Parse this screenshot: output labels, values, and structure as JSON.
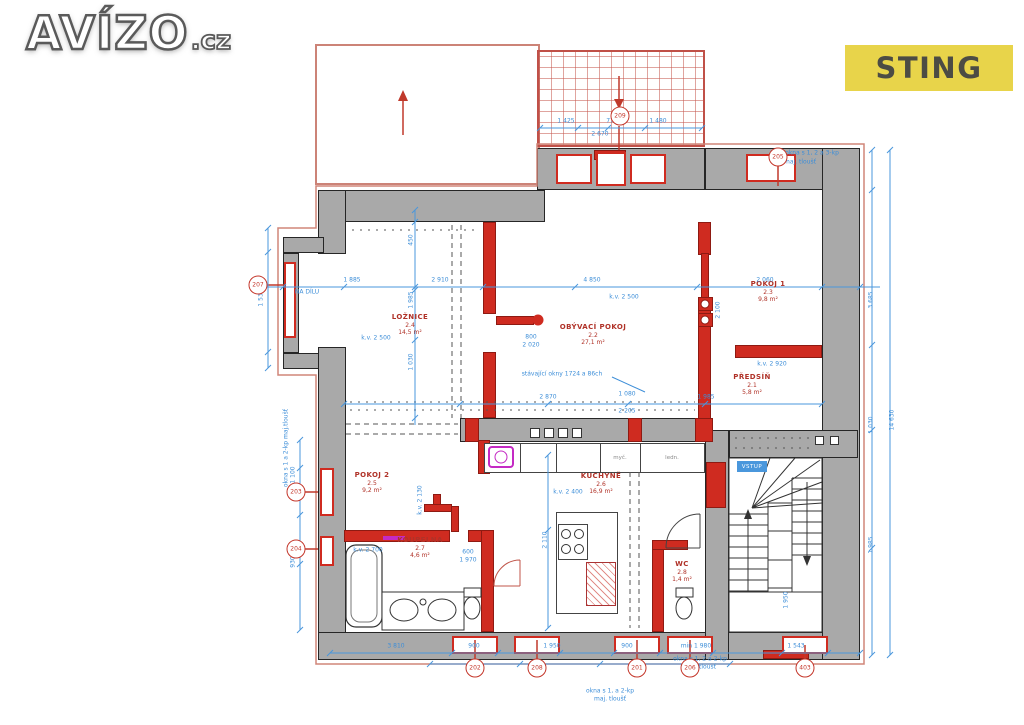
{
  "logo": {
    "main": "AVÍZO",
    "suffix": ".cz"
  },
  "watermark": {
    "label": "STING"
  },
  "plan": {
    "rooms": [
      {
        "name": "LOŽNICE",
        "num": "2.4",
        "area": "14,5 m²",
        "x": 410,
        "y": 325
      },
      {
        "name": "OBÝVACÍ POKOJ",
        "num": "2.2",
        "area": "27,1 m²",
        "x": 593,
        "y": 335
      },
      {
        "name": "POKOJ 1",
        "num": "2.3",
        "area": "9,8 m²",
        "x": 768,
        "y": 292
      },
      {
        "name": "PŘEDSÍŇ",
        "num": "2.1",
        "area": "5,8 m²",
        "x": 752,
        "y": 385
      },
      {
        "name": "POKOJ 2",
        "num": "2.5",
        "area": "9,2 m²",
        "x": 372,
        "y": 483
      },
      {
        "name": "KUCHYNĚ",
        "num": "2.6",
        "area": "16,9 m²",
        "x": 601,
        "y": 484
      },
      {
        "name": "KOUPELNA",
        "num": "2.7",
        "area": "4,6 m²",
        "x": 420,
        "y": 548
      },
      {
        "name": "WC",
        "num": "2.8",
        "area": "1,4 m²",
        "x": 682,
        "y": 572
      }
    ],
    "dims": [
      {
        "t": "1 425",
        "x": 566,
        "y": 121
      },
      {
        "t": "770",
        "x": 612,
        "y": 121
      },
      {
        "t": "1 480",
        "x": 658,
        "y": 121
      },
      {
        "t": "2 670",
        "x": 600,
        "y": 134
      },
      {
        "t": "1 885",
        "x": 352,
        "y": 280
      },
      {
        "t": "2 910",
        "x": 440,
        "y": 280
      },
      {
        "t": "4 850",
        "x": 592,
        "y": 280
      },
      {
        "t": "2 060",
        "x": 765,
        "y": 280
      },
      {
        "t": "2 870",
        "x": 548,
        "y": 397
      },
      {
        "t": "1 080",
        "x": 627,
        "y": 394
      },
      {
        "t": "2 205",
        "x": 627,
        "y": 411
      },
      {
        "t": "1 985",
        "x": 706,
        "y": 397
      },
      {
        "t": "3 810",
        "x": 396,
        "y": 646
      },
      {
        "t": "900",
        "x": 474,
        "y": 646
      },
      {
        "t": "1 950",
        "x": 552,
        "y": 646
      },
      {
        "t": "900",
        "x": 627,
        "y": 646
      },
      {
        "t": "min 1 980",
        "x": 696,
        "y": 646
      },
      {
        "t": "1 543",
        "x": 796,
        "y": 646
      },
      {
        "t": "3 685",
        "x": 871,
        "y": 300,
        "rot": -90
      },
      {
        "t": "1 030",
        "x": 871,
        "y": 425,
        "rot": -90
      },
      {
        "t": "1 985",
        "x": 871,
        "y": 545,
        "rot": -90
      },
      {
        "t": "14 630",
        "x": 892,
        "y": 420,
        "rot": -90
      },
      {
        "t": "1 530",
        "x": 261,
        "y": 298,
        "rot": -90
      },
      {
        "t": "1 100",
        "x": 293,
        "y": 475,
        "rot": -90
      },
      {
        "t": "930",
        "x": 293,
        "y": 562,
        "rot": -90
      },
      {
        "t": "450",
        "x": 411,
        "y": 240,
        "rot": -90
      },
      {
        "t": "1 985",
        "x": 411,
        "y": 300,
        "rot": -90
      },
      {
        "t": "1 030",
        "x": 411,
        "y": 362,
        "rot": -90
      },
      {
        "t": "k.v. 2 500",
        "x": 376,
        "y": 338
      },
      {
        "t": "k.v. 2 500",
        "x": 624,
        "y": 297
      },
      {
        "t": "k.v. 2 920",
        "x": 772,
        "y": 364
      },
      {
        "t": "k.v. 2 400",
        "x": 568,
        "y": 492
      },
      {
        "t": "k.v. 2 700",
        "x": 368,
        "y": 550
      },
      {
        "t": "k.v. 2 130",
        "x": 420,
        "y": 500,
        "rot": -90
      },
      {
        "t": "800",
        "x": 531,
        "y": 337
      },
      {
        "t": "2 020",
        "x": 531,
        "y": 345
      },
      {
        "t": "600",
        "x": 468,
        "y": 552
      },
      {
        "t": "1 970",
        "x": 468,
        "y": 560
      },
      {
        "t": "2 100",
        "x": 718,
        "y": 310,
        "rot": -90
      },
      {
        "t": "1 950",
        "x": 786,
        "y": 600,
        "rot": -90
      },
      {
        "t": "2 110",
        "x": 545,
        "y": 540,
        "rot": -90
      }
    ],
    "annotations": [
      {
        "t": "okna s 1, 2 a 3-kp",
        "x": 812,
        "y": 153
      },
      {
        "t": "maj. tloušť",
        "x": 800,
        "y": 162
      },
      {
        "t": "stávající okny 1724 a 86ch",
        "x": 562,
        "y": 374
      },
      {
        "t": "okna s 1 a 2-kp maj.tloušť",
        "x": 286,
        "y": 448,
        "rot": -90
      },
      {
        "t": "okna s 1, 2 a 2-kp",
        "x": 700,
        "y": 659
      },
      {
        "t": "maj. tloušť",
        "x": 700,
        "y": 667
      },
      {
        "t": "okna s 1, a 2-kp",
        "x": 610,
        "y": 691
      },
      {
        "t": "maj. tloušť",
        "x": 610,
        "y": 699
      },
      {
        "t": "NA DÍLU",
        "x": 307,
        "y": 292
      }
    ],
    "tags": [
      {
        "n": "209",
        "x": 620,
        "y": 116
      },
      {
        "n": "205",
        "x": 778,
        "y": 157
      },
      {
        "n": "207",
        "x": 258,
        "y": 285
      },
      {
        "n": "203",
        "x": 296,
        "y": 492
      },
      {
        "n": "204",
        "x": 296,
        "y": 549
      },
      {
        "n": "202",
        "x": 475,
        "y": 668
      },
      {
        "n": "208",
        "x": 537,
        "y": 668
      },
      {
        "n": "201",
        "x": 637,
        "y": 668
      },
      {
        "n": "206",
        "x": 690,
        "y": 668
      },
      {
        "n": "403",
        "x": 805,
        "y": 668
      }
    ],
    "stair_badge": {
      "label": "VSTUP"
    },
    "fixture_labels": [
      {
        "t": "myč.",
        "x": 620,
        "y": 458
      },
      {
        "t": "ledn.",
        "x": 672,
        "y": 458
      }
    ],
    "colors": {
      "wall_gray": "#a9a9a9",
      "new_wall_red": "#cf2b20",
      "dim_blue": "#3d8ed8",
      "outline_red": "#d08579",
      "label_red": "#b03228",
      "magenta": "#c42ac4",
      "sting_bg": "#e8d44a",
      "sting_text": "#4c4c44"
    }
  }
}
